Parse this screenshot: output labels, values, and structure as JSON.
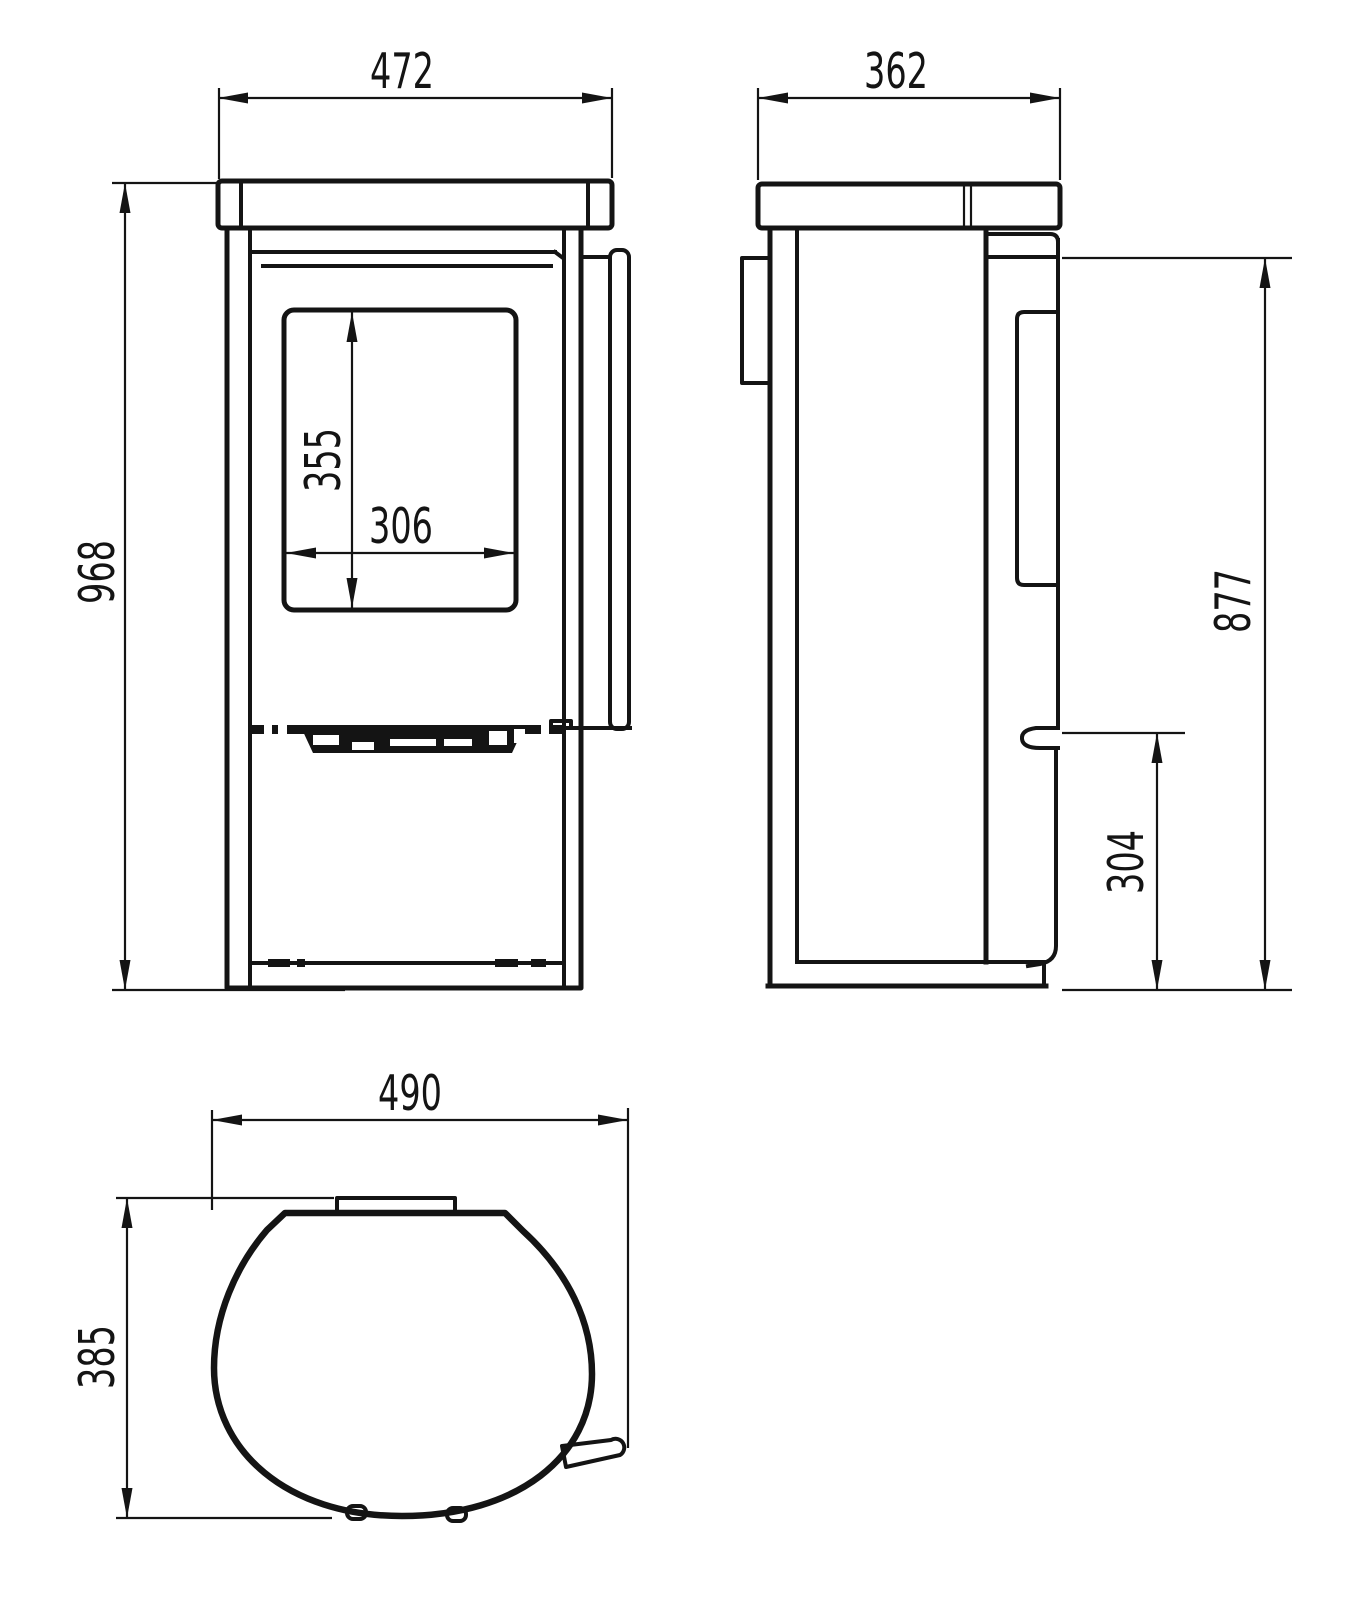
{
  "drawing": {
    "colors": {
      "background": "#ffffff",
      "line": "#141414"
    },
    "front_view": {
      "overall_width": "472",
      "overall_height": "968",
      "glass_height": "355",
      "glass_width": "306"
    },
    "side_view": {
      "overall_depth": "362",
      "body_height": "877",
      "handle_height": "304"
    },
    "top_view": {
      "overall_width": "490",
      "overall_depth": "385"
    }
  }
}
